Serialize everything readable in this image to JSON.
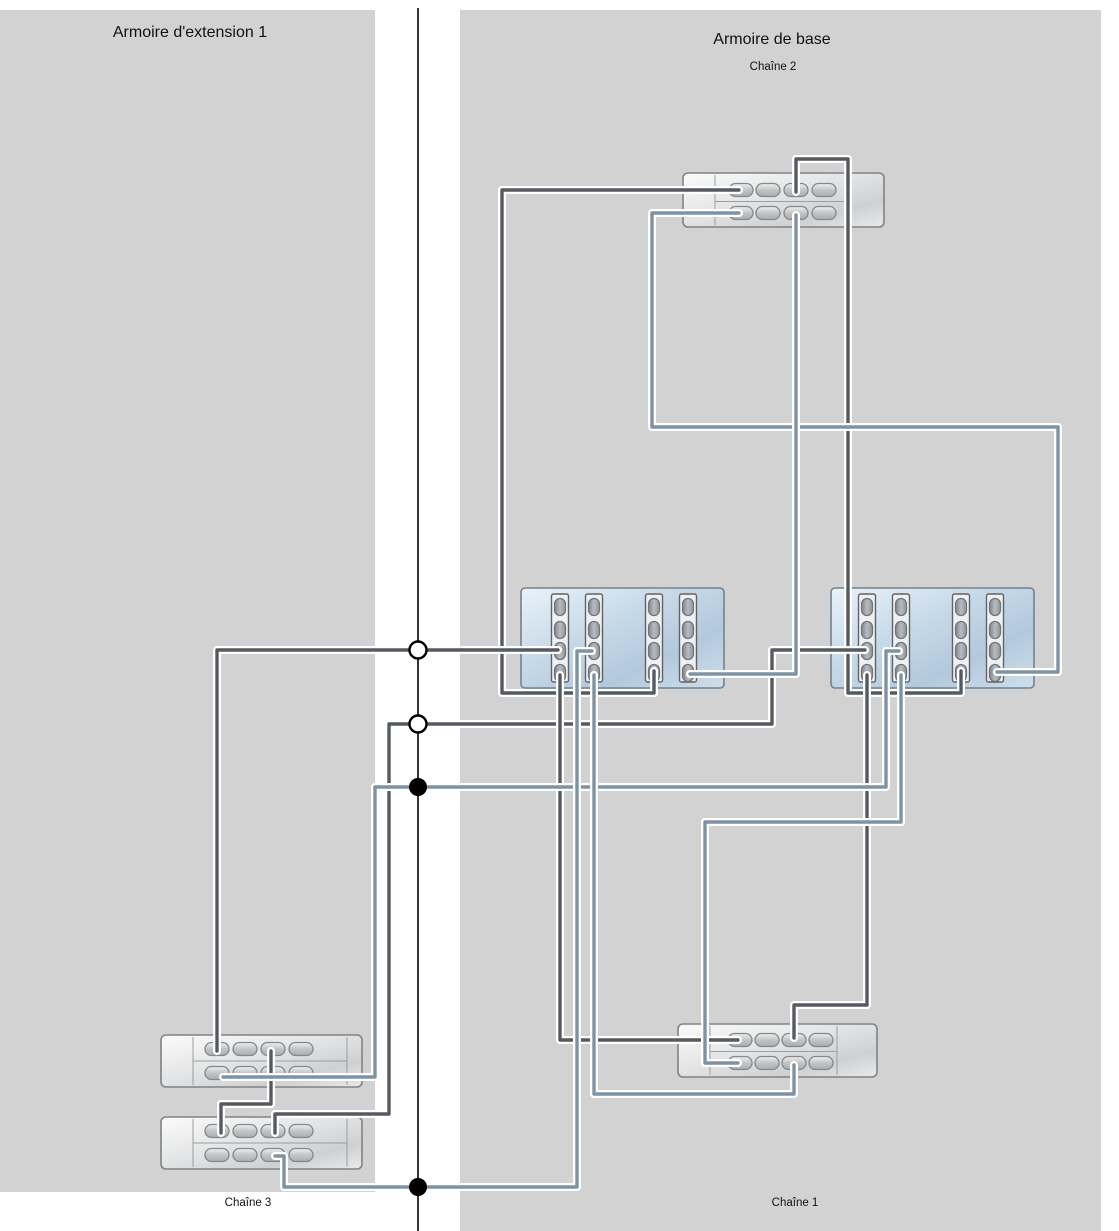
{
  "titles": {
    "left_cabinet": "Armoire d'extension 1",
    "right_cabinet": "Armoire de base",
    "chain2": "Chaîne 2",
    "chain3": "Chaîne 3",
    "chain1": "Chaîne 1"
  },
  "canvas": {
    "width": 1119,
    "height": 1231
  },
  "colors": {
    "panel": "#d2d2d2",
    "background": "#ffffff",
    "cable_dark": "#555a60",
    "cable_blue": "#7d93a4",
    "centerline": "#000000"
  },
  "panels": [
    {
      "name": "left-cabinet-panel",
      "x": 0,
      "y": 10,
      "w": 375,
      "h": 1182
    },
    {
      "name": "right-cabinet-panel",
      "x": 460,
      "y": 10,
      "w": 641,
      "h": 1221
    }
  ],
  "centerline": {
    "x": 418,
    "y1": 8,
    "y2": 1231
  },
  "junctions": [
    {
      "type": "open",
      "x": 418,
      "y": 650
    },
    {
      "type": "open",
      "x": 418,
      "y": 724
    },
    {
      "type": "filled",
      "x": 418,
      "y": 787
    },
    {
      "type": "filled",
      "x": 418,
      "y": 1187
    }
  ],
  "shelves": [
    {
      "name": "shelf-chain2",
      "x": 683,
      "y": 173,
      "w": 201,
      "h": 54,
      "rows": [
        190,
        213
      ],
      "ports": [
        741,
        768,
        796,
        824
      ],
      "div1": 715,
      "div2": 845
    },
    {
      "name": "shelf-chain1",
      "x": 678,
      "y": 1024,
      "w": 199,
      "h": 53,
      "rows": [
        1040,
        1063
      ],
      "ports": [
        740,
        767,
        794,
        821
      ],
      "div1": 710,
      "div2": 837
    },
    {
      "name": "shelf-ext1",
      "x": 161,
      "y": 1035,
      "w": 201,
      "h": 52,
      "rows": [
        1049,
        1073
      ],
      "ports": [
        217,
        245,
        273,
        301
      ],
      "div1": 193,
      "div2": 347
    },
    {
      "name": "shelf-ext2",
      "x": 161,
      "y": 1117,
      "w": 201,
      "h": 52,
      "rows": [
        1131,
        1155
      ],
      "ports": [
        217,
        245,
        273,
        301
      ],
      "div1": 193,
      "div2": 347
    }
  ],
  "controllers": [
    {
      "name": "controller-left",
      "x": 521,
      "y": 588,
      "w": 203,
      "h": 100,
      "slots": [
        560,
        594,
        654,
        688
      ],
      "slot_y": 594,
      "slot_h": 88,
      "port_ys": [
        607,
        630,
        651,
        673
      ]
    },
    {
      "name": "controller-right",
      "x": 831,
      "y": 588,
      "w": 203,
      "h": 100,
      "slots": [
        867,
        901,
        961,
        995
      ],
      "slot_y": 594,
      "slot_h": 88,
      "port_ys": [
        607,
        630,
        651,
        673
      ]
    }
  ],
  "cables": [
    {
      "name": "cable-ctrlL-s3p4-chain2-top-p1",
      "color": "dark",
      "pts": [
        [
          654,
          671
        ],
        [
          654,
          693
        ],
        [
          502,
          693
        ],
        [
          502,
          190
        ],
        [
          739,
          190
        ]
      ]
    },
    {
      "name": "cable-chain2-top-p3-ctrlR-s3p4",
      "color": "dark",
      "pts": [
        [
          796,
          192
        ],
        [
          796,
          159
        ],
        [
          848,
          159
        ],
        [
          848,
          693
        ],
        [
          961,
          693
        ],
        [
          961,
          671
        ]
      ]
    },
    {
      "name": "cable-ctrlL-s1p3-ext1-top-p1",
      "color": "dark",
      "pts": [
        [
          558,
          650
        ],
        [
          217,
          650
        ],
        [
          217,
          1051
        ]
      ]
    },
    {
      "name": "cable-ctrlR-s1p3-ext2-top-p3",
      "color": "dark",
      "pts": [
        [
          865,
          650
        ],
        [
          772,
          650
        ],
        [
          772,
          724
        ],
        [
          389,
          724
        ],
        [
          389,
          1114
        ],
        [
          275,
          1114
        ],
        [
          275,
          1133
        ]
      ]
    },
    {
      "name": "cable-ext1-top-p3-ext2-top-p1",
      "color": "dark",
      "pts": [
        [
          271,
          1051
        ],
        [
          271,
          1104
        ],
        [
          221,
          1104
        ],
        [
          221,
          1133
        ]
      ]
    },
    {
      "name": "cable-ctrlL-s1p4-chain1-top-p1",
      "color": "dark",
      "pts": [
        [
          560,
          675
        ],
        [
          560,
          1040
        ],
        [
          738,
          1040
        ]
      ]
    },
    {
      "name": "cable-ctrlR-s1p4-chain1-top-p3",
      "color": "dark",
      "pts": [
        [
          867,
          675
        ],
        [
          867,
          1005
        ],
        [
          794,
          1005
        ],
        [
          794,
          1038
        ]
      ]
    },
    {
      "name": "cable-chain2-bot-p1-ctrlR-s4p4",
      "color": "blue",
      "pts": [
        [
          739,
          213
        ],
        [
          652,
          213
        ],
        [
          652,
          427
        ],
        [
          1058,
          427
        ],
        [
          1058,
          672
        ],
        [
          997,
          672
        ]
      ]
    },
    {
      "name": "cable-chain2-bot-p3-ctrlL-s4p4",
      "color": "blue",
      "pts": [
        [
          796,
          215
        ],
        [
          796,
          674
        ],
        [
          690,
          674
        ]
      ]
    },
    {
      "name": "cable-ext1-bot-p1-ctrlR-s2p3",
      "color": "blue",
      "pts": [
        [
          223,
          1077
        ],
        [
          375,
          1077
        ],
        [
          375,
          787
        ],
        [
          886,
          787
        ],
        [
          886,
          651
        ],
        [
          899,
          651
        ]
      ]
    },
    {
      "name": "cable-ext2-bot-p3-ctrlL-s2p3",
      "color": "blue",
      "pts": [
        [
          275,
          1156
        ],
        [
          284,
          1156
        ],
        [
          284,
          1187
        ],
        [
          577,
          1187
        ],
        [
          577,
          651
        ],
        [
          592,
          651
        ]
      ]
    },
    {
      "name": "cable-chain1-bot-p3-ctrlL-s2p4",
      "color": "blue",
      "pts": [
        [
          794,
          1065
        ],
        [
          794,
          1094
        ],
        [
          594,
          1094
        ],
        [
          594,
          675
        ]
      ]
    },
    {
      "name": "cable-ctrlR-s2p4-chain1-bot-p1",
      "color": "blue",
      "pts": [
        [
          901,
          675
        ],
        [
          901,
          822
        ],
        [
          705,
          822
        ],
        [
          705,
          1063
        ],
        [
          738,
          1063
        ]
      ]
    }
  ],
  "labels": [
    {
      "name": "left-cabinet-title",
      "bind": "titles.left_cabinet",
      "cx": 190,
      "top": 24,
      "size": "lg"
    },
    {
      "name": "right-cabinet-title",
      "bind": "titles.right_cabinet",
      "cx": 772,
      "top": 31,
      "size": "lg"
    },
    {
      "name": "chain2-label",
      "bind": "titles.chain2",
      "cx": 773,
      "top": 61,
      "size": "sm"
    },
    {
      "name": "chain3-label",
      "bind": "titles.chain3",
      "cx": 248,
      "top": 1197,
      "size": "sm"
    },
    {
      "name": "chain1-label",
      "bind": "titles.chain1",
      "cx": 795,
      "top": 1197,
      "size": "sm"
    }
  ]
}
